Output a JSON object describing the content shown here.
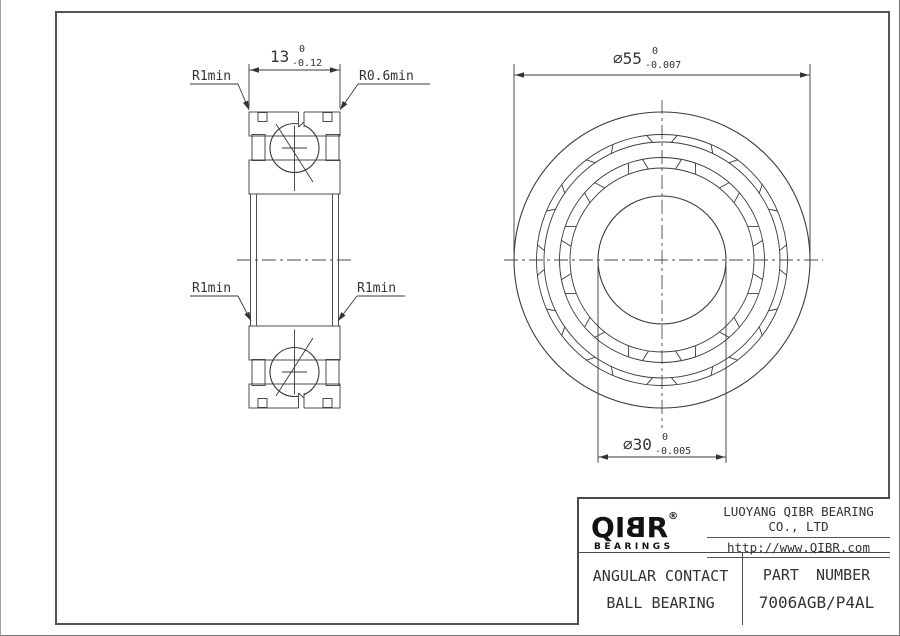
{
  "colors": {
    "line": "#3a3a3a",
    "text": "#333333",
    "background": "#ffffff",
    "logo": "#121212"
  },
  "section_view": {
    "width_dim": {
      "value": "13",
      "tol_upper": "0",
      "tol_lower": "-0.12"
    },
    "label_top_left": "R1min",
    "label_top_right": "R0.6min",
    "label_mid_left": "R1min",
    "label_mid_right": "R1min"
  },
  "front_view": {
    "od_dim": {
      "value": "⌀55",
      "tol_upper": "0",
      "tol_lower": "-0.007"
    },
    "bore_dim": {
      "value": "⌀30",
      "tol_upper": "0",
      "tol_lower": "-0.005"
    }
  },
  "title_block": {
    "logo": {
      "letters": [
        "Q",
        "I",
        "B",
        "R"
      ],
      "registered": "®",
      "subtext": "BEARINGS"
    },
    "company": "LUOYANG QIBR BEARING CO., LTD",
    "website": "http://www.QIBR.com",
    "product_line1": "ANGULAR CONTACT",
    "product_line2": "BALL BEARING",
    "part_number_label": "PART NUMBER",
    "part_number": "7006AGB/P4AL"
  }
}
